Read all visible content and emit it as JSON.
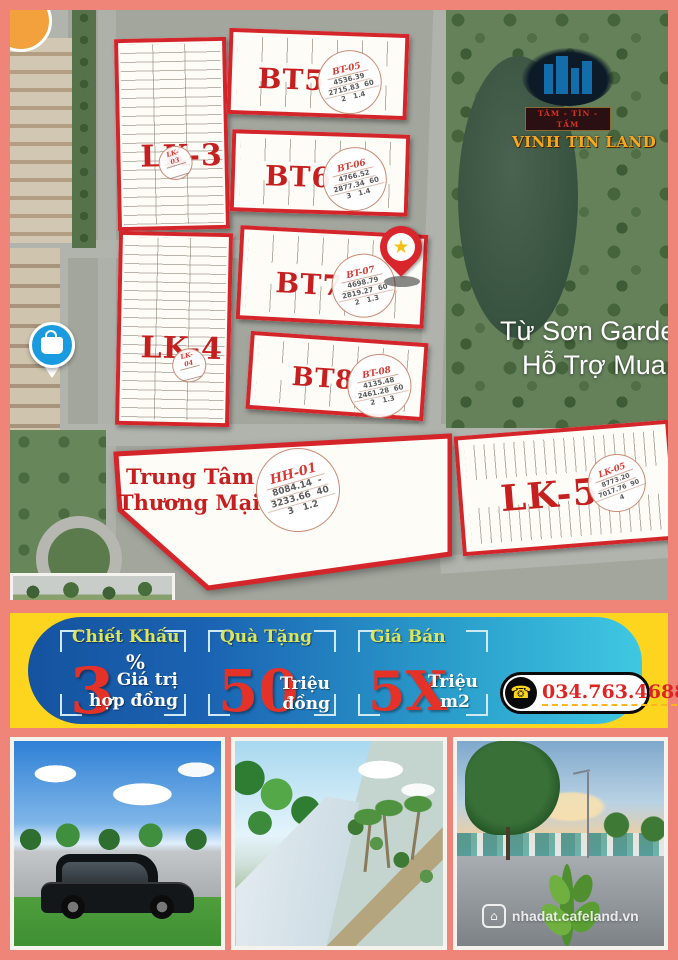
{
  "colors": {
    "frame": "#ef8478",
    "plot_border_red": "#d4252b",
    "label_red": "#c51f1f",
    "banner_yellow": "#fdd41e",
    "banner_blue": "#1b64b3",
    "banner_cyan": "#3fc8e2"
  },
  "icons": {
    "phone": "☎",
    "home": "⌂",
    "star": "★"
  },
  "logo": {
    "tagline": "TÂM - TÍN - TẦM",
    "name": "VINH TIN LAND"
  },
  "map": {
    "place": {
      "line1": "Từ Sơn Garde",
      "line2": "Hỗ Trợ Mua B"
    },
    "lk3": {
      "label": "LK-3",
      "stamp": "LK-03"
    },
    "lk4": {
      "label": "LK-4",
      "stamp": "LK-04"
    },
    "bt5": {
      "label": "BT5",
      "stamp": {
        "title": "BT-05",
        "l1": "4536.39",
        "l2": "2715.83  60",
        "l3": "2   1.4"
      }
    },
    "bt6": {
      "label": "BT6",
      "stamp": {
        "title": "BT-06",
        "l1": "4766.52",
        "l2": "2877.34  60",
        "l3": "3   1.4"
      }
    },
    "bt7": {
      "label": "BT7",
      "stamp": {
        "title": "BT-07",
        "l1": "4698.79",
        "l2": "2819.27  60",
        "l3": "2   1.3"
      }
    },
    "bt8": {
      "label": "BT8",
      "stamp": {
        "title": "BT-08",
        "l1": "4135.48",
        "l2": "2461.28  60",
        "l3": "2   1.3"
      }
    },
    "hh01": {
      "line1": "Trung Tâm",
      "line2": "Thương Mại",
      "stamp": {
        "title": "HH-01",
        "l1": "8084.14  -",
        "l2": "3233.66  40",
        "l3": "3   1.2"
      }
    },
    "lk5": {
      "label": "LK-5",
      "stamp": {
        "title": "LK-05",
        "l1": "8773.20",
        "l2": "7017.76  90",
        "l3": "4"
      }
    }
  },
  "banner": {
    "offer1": {
      "title": "Chiết Khấu",
      "big": "3",
      "unit": "%",
      "line1": "Giá trị",
      "line2": "hợp đồng"
    },
    "offer2": {
      "title": "Quà Tặng",
      "big": "50",
      "line1": "Triệu",
      "line2": "đồng"
    },
    "offer3": {
      "title": "Giá Bán",
      "big": "5X",
      "line1": "Triệu",
      "line2": "m2"
    },
    "phone": "034.763.4688"
  },
  "photos": {
    "watermark": "nhadat.cafeland.vn"
  }
}
